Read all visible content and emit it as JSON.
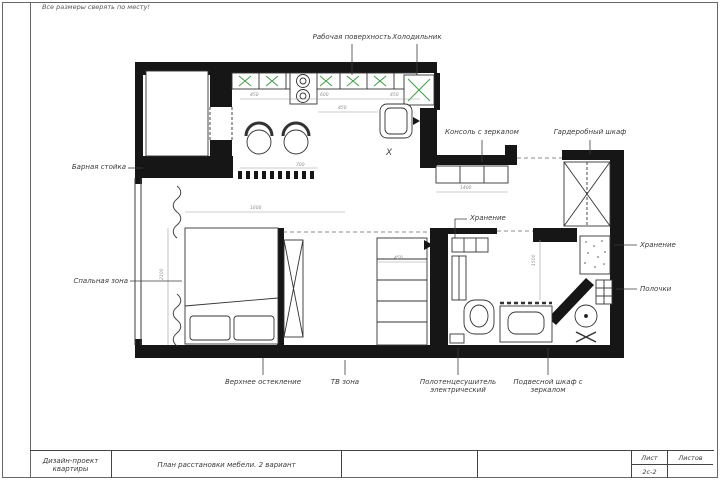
{
  "page": {
    "note": "Все размеры сверять по месту!",
    "title_block": {
      "project_line1": "Дизайн-проект",
      "project_line2": "квартиры",
      "sheet_title": "План расстановки мебели. 2 вариант",
      "sheet_label": "Лист",
      "sheet_number": "2с-2",
      "sheets_label": "Листов"
    }
  },
  "plan": {
    "labels": {
      "work_surface": "Рабочая поверхность",
      "fridge": "Холодильник",
      "console": "Консоль с зеркалом",
      "wardrobe": "Гардеробный шкаф",
      "bar": "Барная стойка",
      "storage_top": "Хранение",
      "storage_right": "Хранение",
      "shelves": "Полочки",
      "sleeping": "Спальная зона",
      "glazing": "Верхнее остекление",
      "tv": "ТВ зона",
      "towel_line1": "Полотенцесушитель",
      "towel_line2": "электрический",
      "hanging_line1": "Подвесной шкаф с",
      "hanging_line2": "зеркалом"
    },
    "x_mark": "X",
    "colors": {
      "wall": "#161616",
      "line": "#3d3d3d",
      "cabinet_accent_green": "#3f9e44",
      "dimension": "#8c8c8c"
    },
    "dimensions": [
      {
        "value": "450",
        "x": 250,
        "y": 93
      },
      {
        "value": "600",
        "x": 320,
        "y": 93
      },
      {
        "value": "450",
        "x": 390,
        "y": 93
      },
      {
        "value": "450",
        "x": 338,
        "y": 106
      },
      {
        "value": "700",
        "x": 296,
        "y": 163
      },
      {
        "value": "1600",
        "x": 250,
        "y": 206
      },
      {
        "value": "2100",
        "x": 160,
        "y": 280,
        "vertical": true
      },
      {
        "value": "450",
        "x": 394,
        "y": 256
      },
      {
        "value": "1400",
        "x": 460,
        "y": 186
      },
      {
        "value": "1500",
        "x": 532,
        "y": 266,
        "vertical": true
      }
    ]
  }
}
